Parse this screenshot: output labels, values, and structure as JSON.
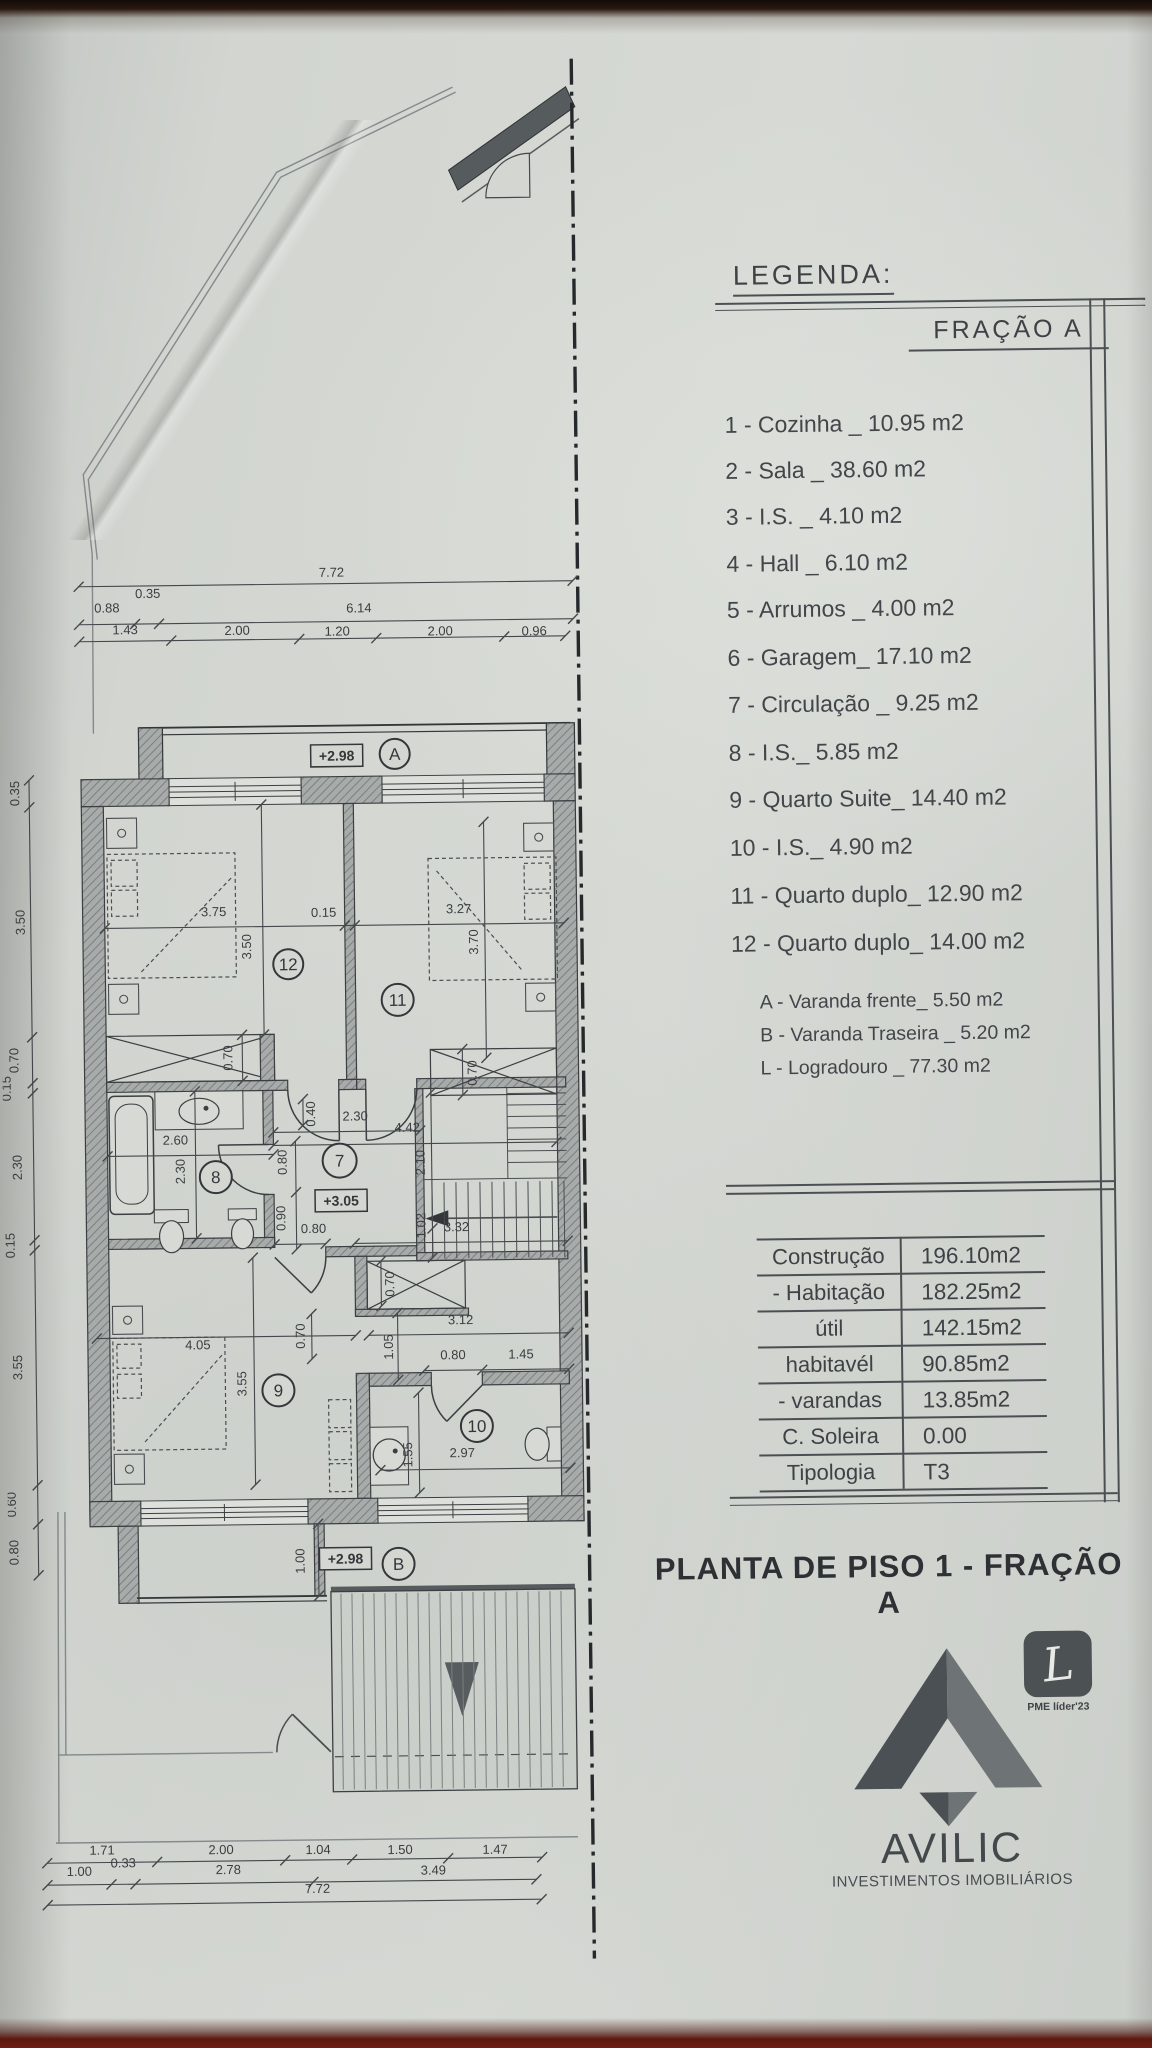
{
  "legend": {
    "title": "LEGENDA:",
    "fraction": "FRAÇÃO A",
    "items": [
      "1 - Cozinha _ 10.95 m2",
      "2 - Sala  _ 38.60 m2",
      "3 - I.S. _ 4.10 m2",
      "4 - Hall _ 6.10 m2",
      "5 - Arrumos _ 4.00 m2",
      "6 - Garagem_ 17.10 m2",
      "7 - Circulação _ 9.25 m2",
      "8 - I.S._ 5.85 m2",
      "9 - Quarto Suite_ 14.40 m2",
      "10 - I.S._ 4.90 m2",
      "11 - Quarto duplo_ 12.90 m2",
      "12 - Quarto duplo_ 14.00 m2"
    ],
    "annex_items": [
      "A - Varanda frente_ 5.50 m2",
      "B - Varanda Traseira _ 5.20 m2",
      "L - Logradouro _ 77.30 m2"
    ]
  },
  "areas_table": {
    "rows": [
      {
        "label": "Construção",
        "value": "196.10m2"
      },
      {
        "label": "- Habitação",
        "value": "182.25m2"
      },
      {
        "label": "útil",
        "value": "142.15m2"
      },
      {
        "label": "habitavél",
        "value": "90.85m2"
      },
      {
        "label": "- varandas",
        "value": "13.85m2"
      },
      {
        "label": "C. Soleira",
        "value": "0.00"
      },
      {
        "label": "Tipologia",
        "value": "T3"
      }
    ]
  },
  "plan_title": "PLANTA DE PISO 1 - FRAÇÃO A",
  "branding": {
    "name": "AVILIC",
    "tagline": "INVESTIMENTOS IMOBILIÁRIOS",
    "badge_letter": "L",
    "badge_label": "PME líder'23"
  },
  "colors": {
    "line": "#3b3f42",
    "wall_fill": "#a7aba9",
    "paper": "#d2d5d0",
    "logo_dark": "#4b5054",
    "logo_light": "#6e7376"
  },
  "plan": {
    "room_markers": [
      {
        "id": "A",
        "x": 396,
        "y": 751,
        "r": 15
      },
      {
        "id": "12",
        "x": 287,
        "y": 960,
        "r": 15
      },
      {
        "id": "11",
        "x": 396,
        "y": 997,
        "r": 16
      },
      {
        "id": "8",
        "x": 212,
        "y": 1172,
        "r": 16
      },
      {
        "id": "7",
        "x": 336,
        "y": 1157,
        "r": 17
      },
      {
        "id": "9",
        "x": 272,
        "y": 1386,
        "r": 16
      },
      {
        "id": "10",
        "x": 470,
        "y": 1424,
        "r": 16
      },
      {
        "id": "B",
        "x": 390,
        "y": 1561,
        "r": 16
      }
    ],
    "level_markers": [
      {
        "text": "+2.98",
        "x": 338,
        "y": 752
      },
      {
        "text": "+3.05",
        "x": 337,
        "y": 1197
      },
      {
        "text": "+2.98",
        "x": 337,
        "y": 1555
      }
    ],
    "dim_labels": [
      {
        "t": "7.72",
        "x": 335,
        "y": 573
      },
      {
        "t": "0.88",
        "x": 110,
        "y": 606
      },
      {
        "t": "0.35",
        "x": 151,
        "y": 592
      },
      {
        "t": "6.14",
        "x": 362,
        "y": 609
      },
      {
        "t": "1.43",
        "x": 128,
        "y": 628
      },
      {
        "t": "2.00",
        "x": 240,
        "y": 630
      },
      {
        "t": "1.20",
        "x": 340,
        "y": 632
      },
      {
        "t": "2.00",
        "x": 443,
        "y": 633
      },
      {
        "t": "0.96",
        "x": 537,
        "y": 634
      },
      {
        "t": "0.35",
        "x": 20,
        "y": 786,
        "r": 1
      },
      {
        "t": "3.50",
        "x": 24,
        "y": 915,
        "r": 1
      },
      {
        "t": "0.70",
        "x": 16,
        "y": 1053,
        "r": 1
      },
      {
        "t": "0.15",
        "x": 8,
        "y": 1081,
        "r": 1
      },
      {
        "t": "2.30",
        "x": 18,
        "y": 1160,
        "r": 1
      },
      {
        "t": "0.15",
        "x": 10,
        "y": 1238,
        "r": 1
      },
      {
        "t": "3.55",
        "x": 16,
        "y": 1360,
        "r": 1
      },
      {
        "t": "0.60",
        "x": 8,
        "y": 1497,
        "r": 1
      },
      {
        "t": "0.80",
        "x": 10,
        "y": 1545,
        "r": 1
      },
      {
        "t": "3.75",
        "x": 213,
        "y": 911
      },
      {
        "t": "0.15",
        "x": 323,
        "y": 913
      },
      {
        "t": "3.27",
        "x": 458,
        "y": 911
      },
      {
        "t": "3.50",
        "x": 250,
        "y": 942,
        "r": 1
      },
      {
        "t": "3.70",
        "x": 477,
        "y": 940,
        "r": 1
      },
      {
        "t": "0.70",
        "x": 230,
        "y": 1053,
        "r": 1
      },
      {
        "t": "0.70",
        "x": 474,
        "y": 1071,
        "r": 1
      },
      {
        "t": "2.60",
        "x": 172,
        "y": 1139
      },
      {
        "t": "2.30",
        "x": 181,
        "y": 1166,
        "r": 1
      },
      {
        "t": "0.40",
        "x": 312,
        "y": 1110,
        "r": 1
      },
      {
        "t": "2.30",
        "x": 352,
        "y": 1117
      },
      {
        "t": "4.42",
        "x": 404,
        "y": 1129
      },
      {
        "t": "0.80",
        "x": 283,
        "y": 1158,
        "r": 1
      },
      {
        "t": "0.90",
        "x": 281,
        "y": 1214,
        "r": 1
      },
      {
        "t": "2.10",
        "x": 421,
        "y": 1160,
        "r": 1
      },
      {
        "t": "1.02",
        "x": 421,
        "y": 1223,
        "r": 1
      },
      {
        "t": "0.80",
        "x": 309,
        "y": 1229
      },
      {
        "t": "3.32",
        "x": 452,
        "y": 1229
      },
      {
        "t": "0.70",
        "x": 389,
        "y": 1281,
        "r": 1
      },
      {
        "t": "0.70",
        "x": 299,
        "y": 1332,
        "r": 1
      },
      {
        "t": "4.05",
        "x": 192,
        "y": 1344
      },
      {
        "t": "3.55",
        "x": 240,
        "y": 1379,
        "r": 1
      },
      {
        "t": "3.12",
        "x": 455,
        "y": 1322
      },
      {
        "t": "1.05",
        "x": 387,
        "y": 1344,
        "r": 1
      },
      {
        "t": "0.80",
        "x": 447,
        "y": 1357
      },
      {
        "t": "1.45",
        "x": 515,
        "y": 1357
      },
      {
        "t": "2.97",
        "x": 455,
        "y": 1455
      },
      {
        "t": "1.55",
        "x": 405,
        "y": 1452,
        "r": 1
      },
      {
        "t": "1.00",
        "x": 296,
        "y": 1557,
        "r": 1
      },
      {
        "t": "1.71",
        "x": 90,
        "y": 1848
      },
      {
        "t": "2.00",
        "x": 209,
        "y": 1849
      },
      {
        "t": "1.04",
        "x": 306,
        "y": 1850
      },
      {
        "t": "1.50",
        "x": 388,
        "y": 1851
      },
      {
        "t": "1.47",
        "x": 483,
        "y": 1852
      },
      {
        "t": "1.00",
        "x": 67,
        "y": 1869
      },
      {
        "t": "0.33",
        "x": 111,
        "y": 1861
      },
      {
        "t": "2.78",
        "x": 216,
        "y": 1869
      },
      {
        "t": "3.49",
        "x": 421,
        "y": 1872
      },
      {
        "t": "7.72",
        "x": 305,
        "y": 1889
      }
    ]
  }
}
